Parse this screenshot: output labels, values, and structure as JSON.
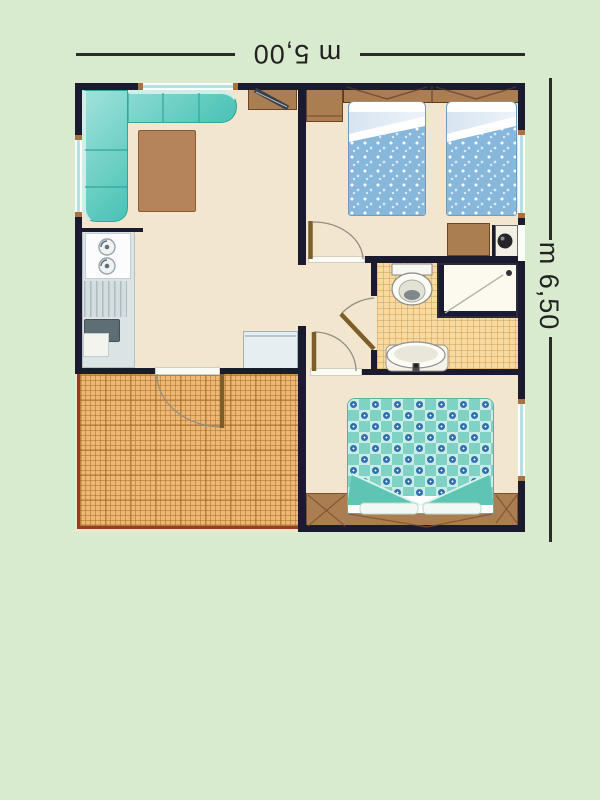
{
  "dimension_labels": {
    "width": "m 5,00",
    "height": "m 6,50"
  },
  "palette": {
    "background": "#d9ebce",
    "wall": "#1b1b30",
    "floor_cream": "#f3e6cf",
    "terrace_orange": "#edb873",
    "terrace_border_red": "#9c3a22",
    "bathroom_tile": "#f7d9a2",
    "sofa_teal": "#49c2b6",
    "twin_bed_blue": "#87b7db",
    "double_bed_teal": "#7fd2c4",
    "duvet_motif_blue": "#2e6fad",
    "furniture_wood": "#ab7e52",
    "door_leaf_brown": "#7d5d28",
    "dimension_text": "#222222",
    "window_glass": "#b7dfe8"
  }
}
